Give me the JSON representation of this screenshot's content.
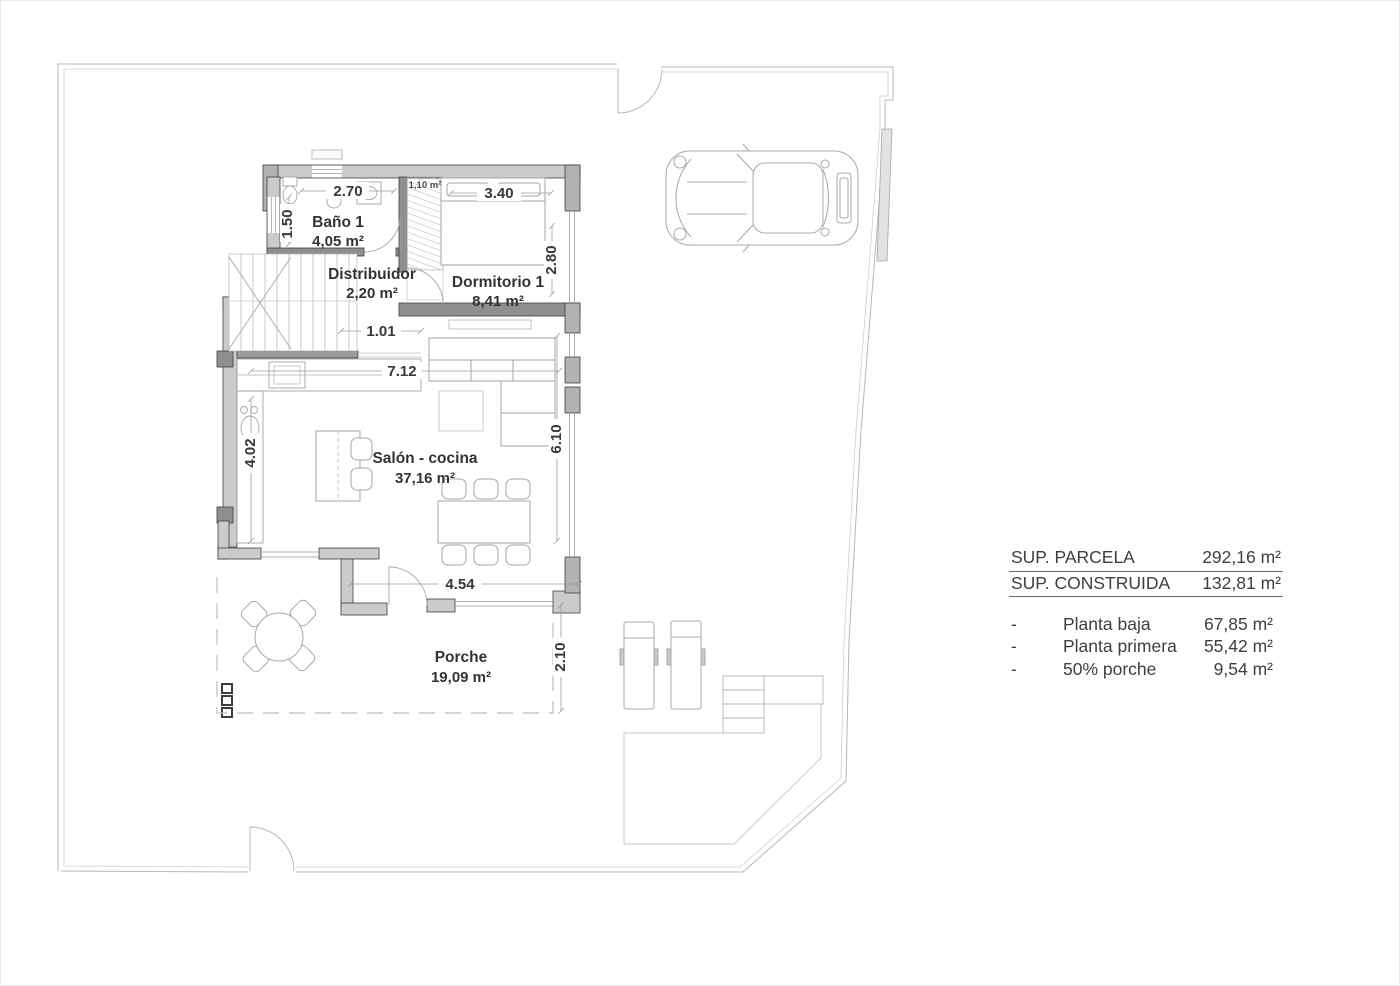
{
  "rooms": {
    "bano": {
      "name": "Baño 1",
      "area": "4,05 m²"
    },
    "distribuidor": {
      "name": "Distribuidor",
      "area": "2,20 m²"
    },
    "dormitorio": {
      "name": "Dormitorio 1",
      "area": "8,41 m²"
    },
    "salon": {
      "name": "Salón - cocina",
      "area": "37,16 m²"
    },
    "porche": {
      "name": "Porche",
      "area": "19,09 m²"
    },
    "closet_area": "1,10 m²"
  },
  "dimensions": {
    "bano_w": "2.70",
    "bano_h": "1.50",
    "dorm_w": "3.40",
    "dorm_h": "2.80",
    "hall": "1.01",
    "salon_w": "7.12",
    "kitchen_h": "4.02",
    "salon_h": "6.10",
    "porche_w": "4.54",
    "porche_h": "2.10"
  },
  "summary": {
    "totals": [
      {
        "label": "SUP. PARCELA",
        "value": "292,16 m²"
      },
      {
        "label": "SUP. CONSTRUIDA",
        "value": "132,81 m²"
      }
    ],
    "breakdown": [
      {
        "bullet": "-",
        "label": "Planta baja",
        "value": "67,85 m²"
      },
      {
        "bullet": "-",
        "label": "Planta primera",
        "value": "55,42 m²"
      },
      {
        "bullet": "-",
        "label": "50% porche",
        "value": "9,54 m²"
      }
    ]
  },
  "colors": {
    "wall_fill": "#cbcbcb",
    "wall_dark": "#3f3f3f",
    "pier_fill": "#b2b2b2",
    "boundary": "#b8b8b8",
    "furniture": "#a6a6a6",
    "text": "#383838"
  }
}
